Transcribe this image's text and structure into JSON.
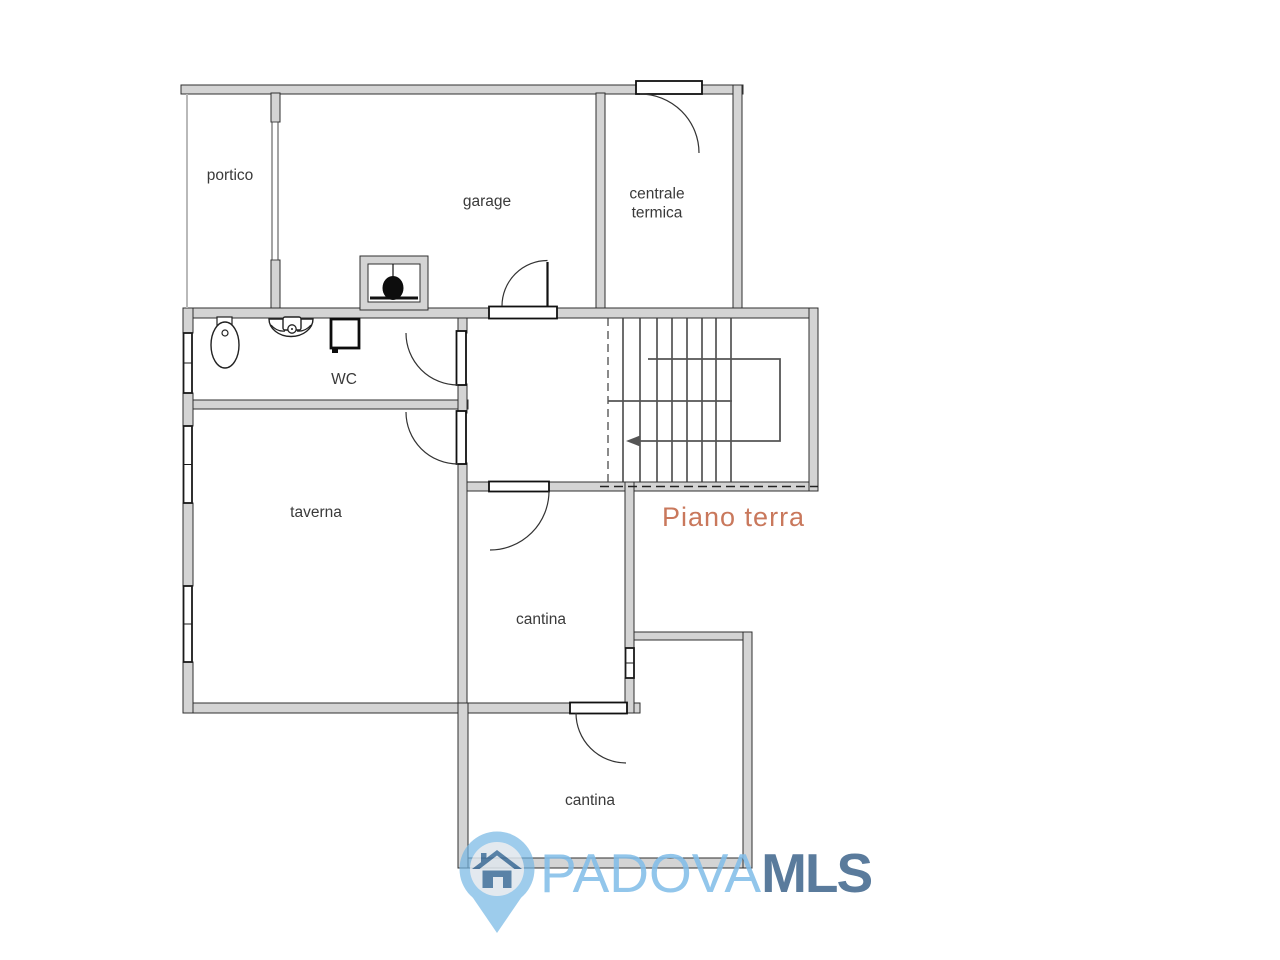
{
  "floor_label": {
    "text": "Piano terra",
    "color": "#c9785c"
  },
  "rooms": [
    {
      "name": "portico"
    },
    {
      "name": "garage"
    },
    {
      "name": "centrale termica"
    },
    {
      "name": "WC"
    },
    {
      "name": "taverna"
    },
    {
      "name": "cantina"
    },
    {
      "name": "cantina"
    }
  ],
  "watermark": {
    "city": "PADOVA",
    "suffix": "MLS",
    "city_color": "#82bee9",
    "suffix_color": "#42688e",
    "pin_color": "#74b6e4",
    "pin_inner_color": "#e4e9ee",
    "house_icon_color": "#41709b"
  },
  "plan": {
    "wall_fill": "#d4d4d4",
    "wall_edge": "#2f2f2f",
    "line_color": "#3d3d3d",
    "background": "#ffffff"
  }
}
